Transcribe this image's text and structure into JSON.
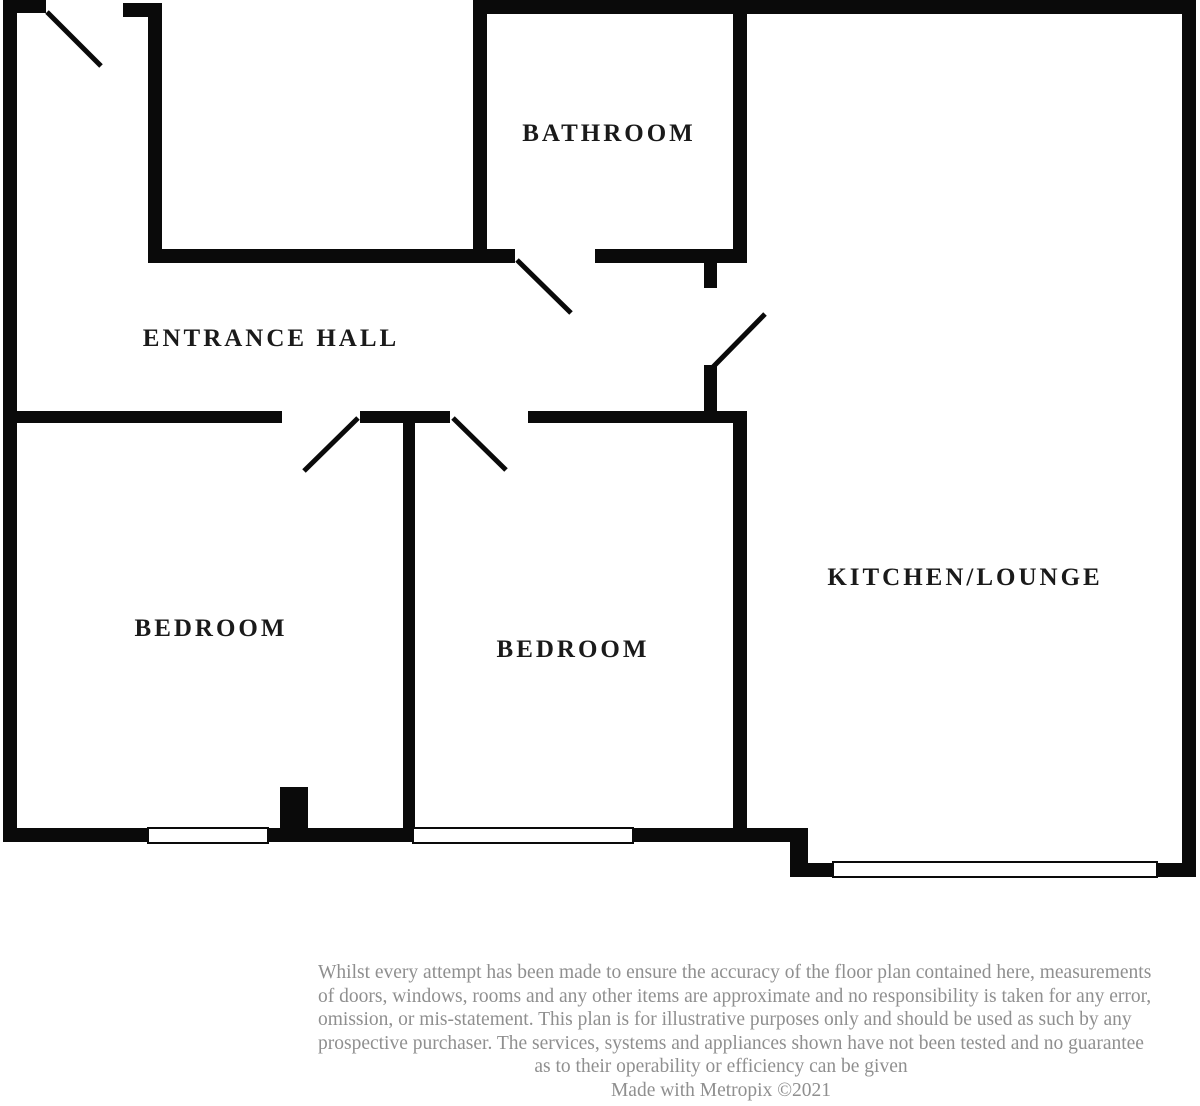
{
  "floorplan": {
    "title": "Flat floor plan",
    "rooms": {
      "bathroom": {
        "label": "BATHROOM"
      },
      "entrance_hall": {
        "label": "ENTRANCE HALL"
      },
      "bedroom_left": {
        "label": "BEDROOM"
      },
      "bedroom_middle": {
        "label": "BEDROOM"
      },
      "kitchen_lounge": {
        "label": "KITCHEN/LOUNGE"
      }
    },
    "colors": {
      "wall": "#0a0a0a",
      "label_text": "#1a1a1a",
      "disclaimer_text": "#8f8f8f",
      "background": "#ffffff"
    }
  },
  "disclaimer": {
    "lines": [
      "Whilst every attempt has been made to ensure the accuracy of the floor plan contained here, measurements",
      "of doors, windows, rooms and any other items are approximate and no responsibility is taken for any error,",
      "omission, or mis-statement. This plan is for illustrative purposes only and should be used as such by any",
      "prospective purchaser. The services, systems and appliances shown have not been tested and no guarantee",
      "as to their operability or efficiency can be given"
    ],
    "credit": "Made with Metropix ©2021"
  }
}
